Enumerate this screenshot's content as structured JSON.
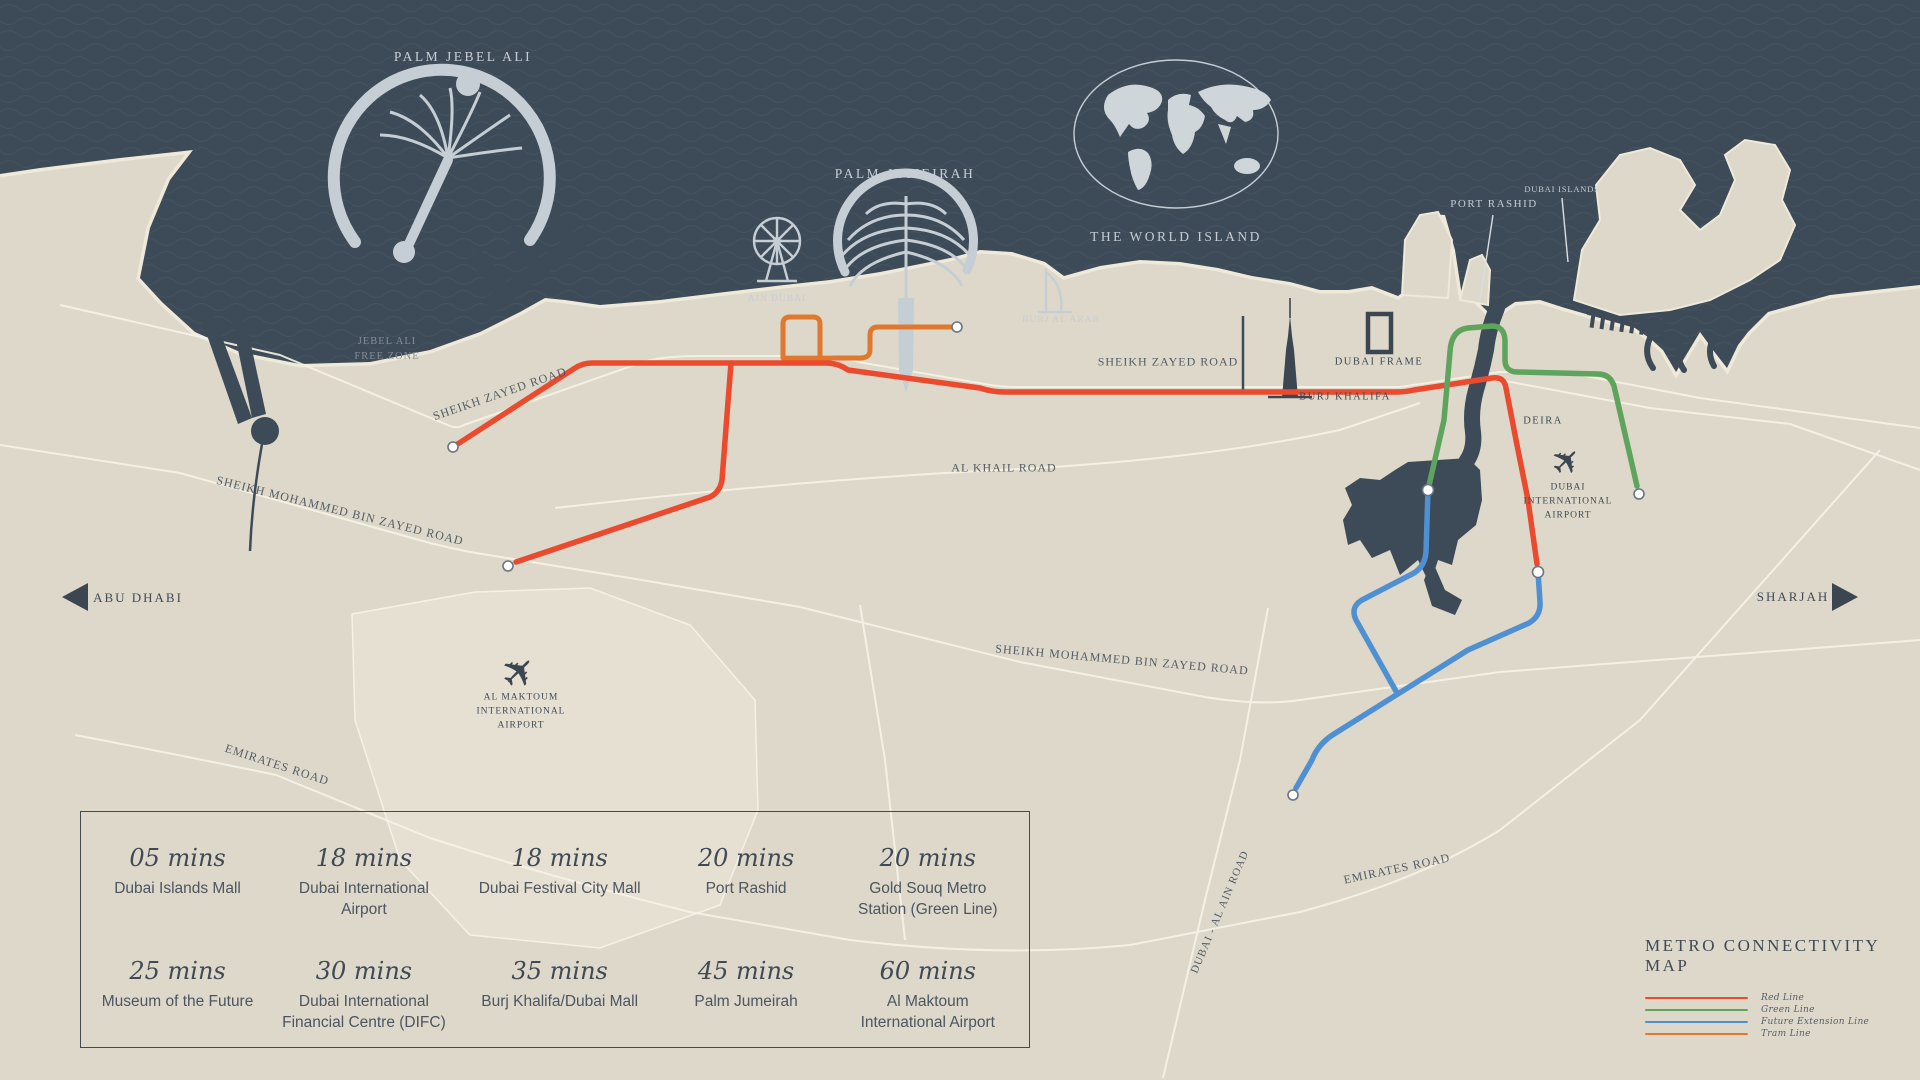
{
  "colors": {
    "sea": "#3d4a57",
    "land": "#ddd8c9",
    "land_light": "#e7e1d3",
    "road": "#f7f3e7",
    "dark_feature": "#3f4a55",
    "light_label": "#c6ced5",
    "red_line": "#ea4a2d",
    "green_line": "#5fa45c",
    "blue_line": "#4e90d1",
    "tram_line": "#e0792f"
  },
  "icons": {
    "plane": "✈"
  },
  "sea_labels": {
    "palm_jebel_ali": "PALM JEBEL ALI",
    "palm_jumeirah": "PALM JUMEIRAH",
    "the_world_island": "THE WORLD ISLAND",
    "ain_dubai": "AIN DUBAI",
    "burj_al_arab": "BURJ AL ARAB",
    "port_rashid": "PORT RASHID",
    "dubai_islands": "DUBAI ISLANDS"
  },
  "land_labels": {
    "jebel_ali_free_zone": "JEBEL ALI\nFREE ZONE",
    "burj_khalifa": "BURJ KHALIFA",
    "dubai_frame": "DUBAI FRAME",
    "deira": "DEIRA",
    "dubai_international_airport": "DUBAI\nINTERNATIONAL\nAIRPORT",
    "al_maktoum_international_airport": "AL MAKTOUM\nINTERNATIONAL\nAIRPORT"
  },
  "road_labels": {
    "sheikh_zayed_road_west": "SHEIKH ZAYED ROAD",
    "sheikh_zayed_road_east": "SHEIKH ZAYED ROAD",
    "al_khail_road": "AL KHAIL ROAD",
    "smbz_west": "SHEIKH MOHAMMED BIN ZAYED ROAD",
    "smbz_east": "SHEIKH MOHAMMED BIN ZAYED ROAD",
    "emirates_road_west": "EMIRATES ROAD",
    "emirates_road_east": "EMIRATES ROAD",
    "dubai_al_ain_road": "DUBAI - AL AIN ROAD"
  },
  "directions": {
    "west": "ABU DHABI",
    "east": "SHARJAH"
  },
  "travel_times": [
    {
      "time": "05 mins",
      "label": "Dubai Islands Mall"
    },
    {
      "time": "18 mins",
      "label": "Dubai International Airport"
    },
    {
      "time": "18 mins",
      "label": "Dubai Festival City Mall"
    },
    {
      "time": "20 mins",
      "label": "Port Rashid"
    },
    {
      "time": "20 mins",
      "label": "Gold Souq Metro Station (Green Line)"
    },
    {
      "time": "25 mins",
      "label": "Museum of the Future"
    },
    {
      "time": "30 mins",
      "label": "Dubai International Financial Centre (DIFC)"
    },
    {
      "time": "35 mins",
      "label": "Burj Khalifa/Dubai Mall"
    },
    {
      "time": "45 mins",
      "label": "Palm Jumeirah"
    },
    {
      "time": "60 mins",
      "label": "Al Maktoum International Airport"
    }
  ],
  "metro_legend": {
    "title": "METRO CONNECTIVITY MAP",
    "items": [
      {
        "label": "Red Line",
        "color": "#ea4a2d"
      },
      {
        "label": "Green Line",
        "color": "#5fa45c"
      },
      {
        "label": "Future Extension Line",
        "color": "#4e90d1"
      },
      {
        "label": "Tram Line",
        "color": "#e0792f"
      }
    ]
  }
}
